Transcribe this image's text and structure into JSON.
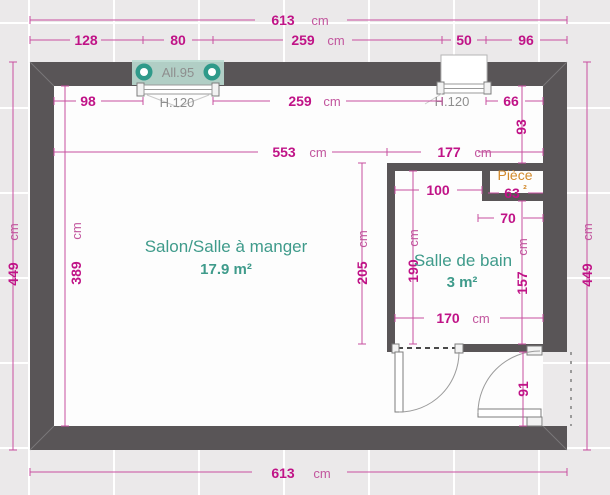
{
  "unit": "cm",
  "rooms": {
    "salon": {
      "name": "Salon/Salle à manger",
      "area": "17.9 m²"
    },
    "bathroom": {
      "name": "Salle de bain",
      "area": "3 m²"
    },
    "piece": {
      "name": "Pièce",
      "area_superscript": "²"
    }
  },
  "windows": {
    "left": {
      "sill_label": "All.95",
      "height_label": "H.120"
    },
    "right": {
      "height_label": "H.120"
    }
  },
  "dimensions": {
    "total_width_top": "613",
    "top_seg_left": "128",
    "top_window_left": "80",
    "top_seg_mid": "259",
    "top_window_right": "50",
    "top_seg_right": "96",
    "inner_top_left": "98",
    "inner_top_mid": "259",
    "inner_top_right": "66",
    "right_inner_height": "93",
    "interior_width": "553",
    "bathroom_zone_width": "177",
    "outer_height_left": "449",
    "inner_height_left": "389",
    "outer_height_right": "449",
    "partition_height": "205",
    "bathroom_inner_height": "190",
    "bathroom_right_height": "157",
    "niche_offset": "100",
    "niche_width": "63",
    "niche_depth": "70",
    "bathroom_width": "170",
    "door_width": "91",
    "total_width_bottom": "613"
  },
  "colors": {
    "dimension_number": "#c01387",
    "dimension_unit": "#c2569e",
    "wall": "#595557",
    "room_label": "#3f9b8b",
    "height_label": "#8e8e8e",
    "piece_label": "#d28a2c",
    "window_accent": "#2f9a8a"
  }
}
